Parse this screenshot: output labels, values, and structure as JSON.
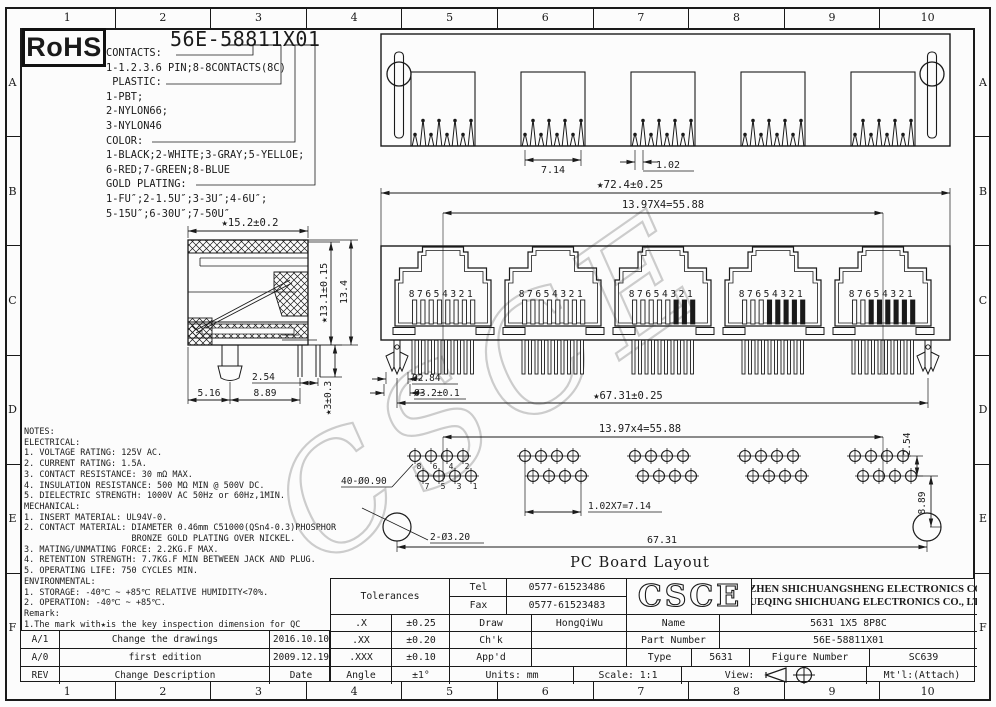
{
  "page": {
    "background": "#fcfcfc",
    "line_color": "#1a1a1a",
    "watermark_color": "#cccccc"
  },
  "watermark": "CSCE",
  "rohs_badge": "RoHS",
  "title_part_number": "56E-58811X01",
  "ordering_legend": {
    "lines": [
      "CONTACTS:",
      "1-1.2.3.6 PIN;8-8CONTACTS(8C)",
      " PLASTIC:",
      "1-PBT;",
      "2-NYLON66;",
      "3-NYLON46",
      "COLOR:",
      "1-BLACK;2-WHITE;3-GRAY;5-YELLOE;",
      "6-RED;7-GREEN;8-BLUE",
      "GOLD PLATING:",
      "1-FU″;2-1.5U″;3-3U″;4-6U″;",
      "5-15U″;6-30U″;7-50U″"
    ]
  },
  "zones": {
    "columns": [
      "1",
      "2",
      "3",
      "4",
      "5",
      "6",
      "7",
      "8",
      "9",
      "10"
    ],
    "rows": [
      "A",
      "B",
      "C",
      "D",
      "E",
      "F"
    ]
  },
  "top_view": {
    "dim_port_width": "7.14",
    "dim_pin_pitch": "1.02"
  },
  "front_view": {
    "dim_overall_width": "★72.4±0.25",
    "dim_port_pitch": "13.97X4=55.88",
    "pin_numbers": "87654321",
    "dim_peg_tip": "Ø2.84",
    "dim_peg_hole": "Ø3.2±0.1",
    "dim_peg_span": "★67.31±0.25"
  },
  "side_view": {
    "dim_depth": "★15.2±0.2",
    "dim_height_inner": "★13.1±0.15",
    "dim_height_overall": "13.4",
    "dim_leg_pitch": "2.54",
    "dim_front": "5.16",
    "dim_back": "8.89",
    "dim_leg_length": "★3±0.3"
  },
  "pcb_layout": {
    "caption": "PC Board Layout",
    "dim_group_pitch": "13.97x4=55.88",
    "dim_row_offset": "2.54",
    "dim_hole_to_peg": "8.89",
    "dim_pin_holes": "40-Ø0.90",
    "dim_pin_pitch": "1.02X7=7.14",
    "dim_peg_holes": "2-Ø3.20",
    "dim_span": "67.31",
    "pin_numbers_top": [
      "8",
      "6",
      "4",
      "2"
    ],
    "pin_numbers_bottom": [
      "7",
      "5",
      "3",
      "1"
    ]
  },
  "notes": {
    "lines": [
      "NOTES:",
      "ELECTRICAL:",
      "1. VOLTAGE RATING: 125V AC.",
      "2. CURRENT RATING: 1.5A.",
      "3. CONTACT RESISTANCE: 30 mΩ MAX.",
      "4. INSULATION RESISTANCE: 500 MΩ MIN @ 500V DC.",
      "5. DIELECTRIC STRENGTH: 1000V AC 50Hz or 60Hz,1MIN.",
      "MECHANICAL:",
      "1. INSERT MATERIAL: UL94V-0.",
      "2. CONTACT MATERIAL: DIAMETER 0.46mm C51000(QSn4-0.3)PHOSPHOR",
      "                     BRONZE GOLD PLATING OVER NICKEL.",
      "3. MATING/UNMATING FORCE: 2.2KG.F MAX.",
      "4. RETENTION STRENGTH: 7.7KG.F MIN BETWEEN JACK AND PLUG.",
      "5. OPERATING LIFE: 750 CYCLES MIN.",
      "ENVIRONMENTAL:",
      "1. STORAGE: -40℃ ~ +85℃ RELATIVE HUMIDITY<70%.",
      "2. OPERATION: -40℃ ~ +85℃.",
      "Remark:",
      "1.The mark with★is the key inspection dimension for QC"
    ]
  },
  "revision_table": {
    "rows": [
      {
        "rev": "A/1",
        "description": "Change the drawings",
        "date": "2016.10.10"
      },
      {
        "rev": "A/0",
        "description": "first edition",
        "date": "2009.12.19"
      },
      {
        "rev": "REV",
        "description": "Change Description",
        "date": "Date"
      }
    ]
  },
  "title_block": {
    "tolerances_label": "Tolerances",
    "tol_x_label": ".X",
    "tol_x": "±0.25",
    "tol_xx_label": ".XX",
    "tol_xx": "±0.20",
    "tol_xxx_label": ".XXX",
    "tol_xxx": "±0.10",
    "angle_label": "Angle",
    "angle": "±1°",
    "tel_label": "Tel",
    "tel": "0577-61523486",
    "fax_label": "Fax",
    "fax": "0577-61523483",
    "logo": "CSCE",
    "company_line1": "SHENZHEN SHICHUANGSHENG ELECTRONICS CO.,LTD",
    "company_line2": "YUEQING SHICHUANG ELECTRONICS CO., LTD",
    "draw_label": "Draw",
    "draw": "HongQiWu",
    "chk_label": "Ch'k",
    "chk": "",
    "appd_label": "App'd",
    "appd": "",
    "name_label": "Name",
    "name": "5631 1X5 8P8C",
    "part_number_label": "Part Number",
    "part_number": "56E-58811X01",
    "type_label": "Type",
    "type": "5631",
    "figure_label": "Figure Number",
    "figure": "SC639",
    "units": "Units: mm",
    "scale": "Scale: 1:1",
    "view_label": "View:",
    "mtl": "Mt'l:(Attach)"
  }
}
